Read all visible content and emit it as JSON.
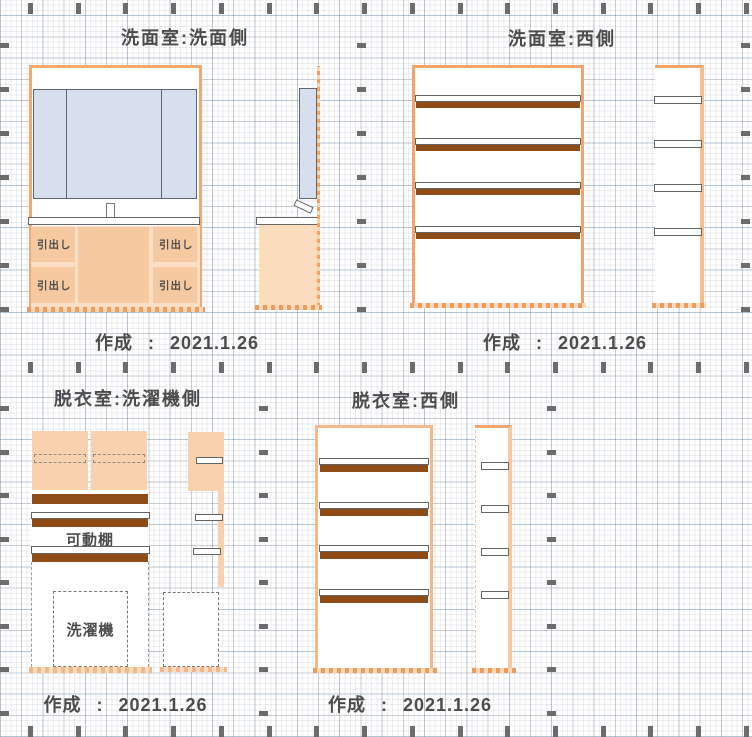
{
  "document": {
    "created_label": "作成",
    "created_separator": ":",
    "created_date": "2021.1.26"
  },
  "panels": {
    "washroom_vanity": {
      "title": "洗面室:洗面側",
      "drawer_label": "引出し"
    },
    "washroom_west": {
      "title": "洗面室:西側"
    },
    "dressing_washer": {
      "title": "脱衣室:洗濯機側",
      "movable_shelf_label": "可動棚",
      "washing_machine_label": "洗濯機"
    },
    "dressing_west": {
      "title": "脱衣室:西側"
    }
  },
  "colors": {
    "accent_orange": "#f0a46e",
    "shelf_brown": "#8e4c19",
    "cabinet_peach": "#f7c9a0",
    "door_peach": "#f8d1ae",
    "mirror_blue": "#d6dfee",
    "text_gray": "#4c4c4c",
    "tick_gray": "#6c6c6c"
  }
}
